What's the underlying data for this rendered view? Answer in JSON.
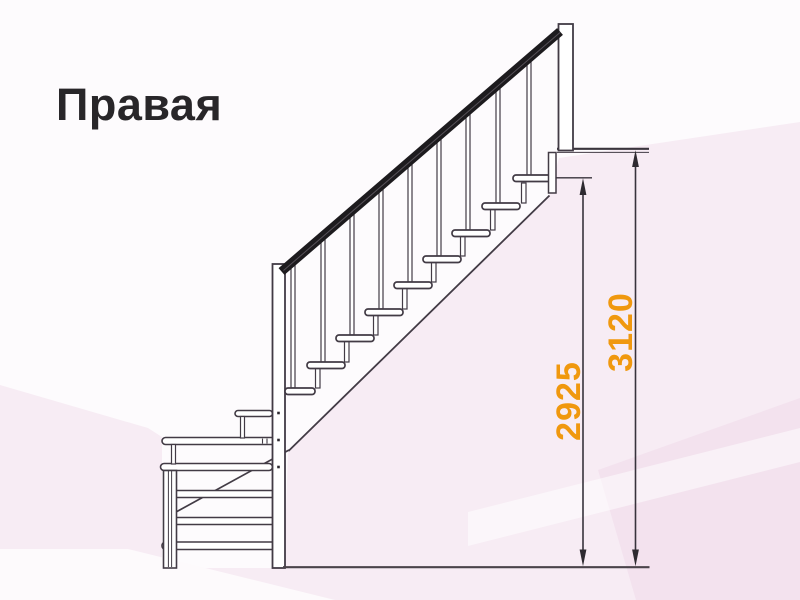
{
  "title": "Правая",
  "diagram": {
    "type": "staircase-side-view-right"
  },
  "dimensions": {
    "inner_height": "2925",
    "total_height": "3120"
  },
  "colors": {
    "dimension_label": "#f0980e",
    "drawing_line": "#423b45",
    "handrail": "#1d1b1e",
    "background_tint": "#f7ecf4"
  }
}
